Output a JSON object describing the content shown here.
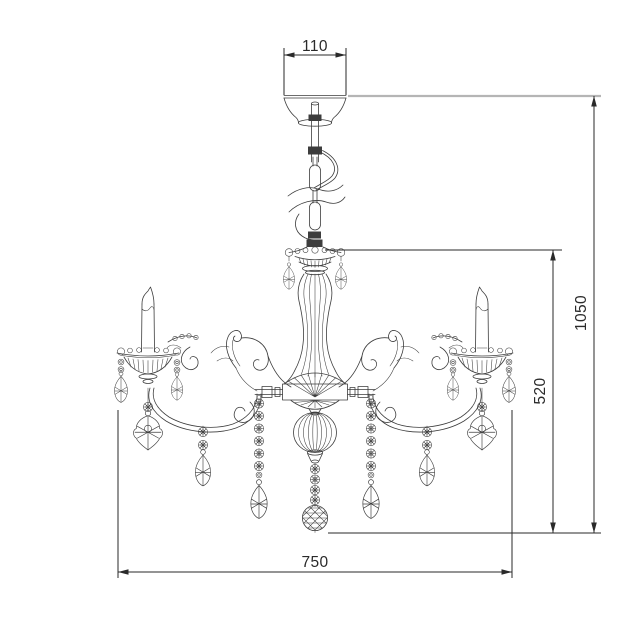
{
  "dimensions": {
    "canopy_width": {
      "label": "110"
    },
    "overall_height": {
      "label": "1050"
    },
    "fixture_height": {
      "label": "520"
    },
    "fixture_width": {
      "label": "750"
    }
  },
  "colors": {
    "background": "#ffffff",
    "line": "#3d3d3d",
    "dimension": "#2a2a2a",
    "ceiling": "#b5b5b5"
  }
}
